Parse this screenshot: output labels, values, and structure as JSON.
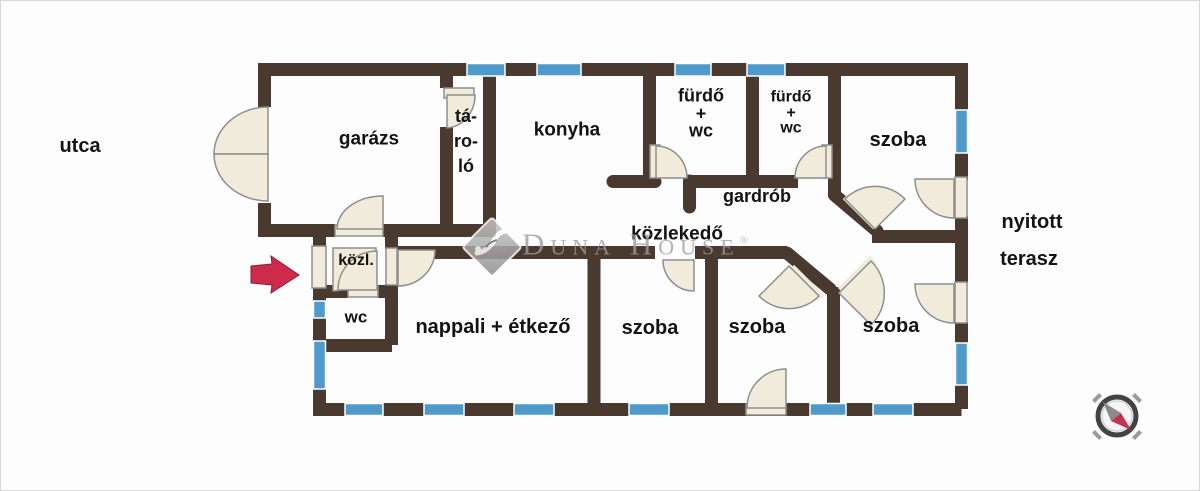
{
  "document": {
    "type": "real-estate floor plan",
    "language": "Hungarian"
  },
  "labels": {
    "street": "utca",
    "garage": "garázs",
    "storage": "tá-\nro-\nló",
    "kitchen": "konyha",
    "bathroom1": "fürdő\n+\nwc",
    "bathroom2": "fürdő\n+\nwc",
    "room_top_right": "szoba",
    "wardrobe": "gardrób",
    "hallway": "közlekedő",
    "hall_small": "közl.",
    "wc": "wc",
    "living_dining": "nappali + étkező",
    "room_mid_1": "szoba",
    "room_mid_2": "szoba",
    "room_bottom_right": "szoba",
    "terrace_line1": "nyitott",
    "terrace_line2": "terasz"
  },
  "watermark": {
    "brand": "Duna House",
    "registered_mark": "®"
  },
  "icons": [
    {
      "name": "entrance-arrow-icon",
      "meaning": "entrance direction from street"
    },
    {
      "name": "compass-icon",
      "meaning": "north orientation rose"
    },
    {
      "name": "dunahouse-logo-diamond",
      "meaning": "agency watermark logo"
    }
  ],
  "colors": {
    "wall": "#4a392e",
    "window": "#4f9aca",
    "door_leaf": "#f1ebdc",
    "door_outline": "#8e8e8e",
    "entrance_arrow": "#ce2b4c",
    "watermark_gray": "#9c9c9c",
    "compass_needle_red": "#c03553",
    "compass_needle_gray": "#8a8a8a",
    "background": "#fdfdfd",
    "label_text": "#131313"
  }
}
